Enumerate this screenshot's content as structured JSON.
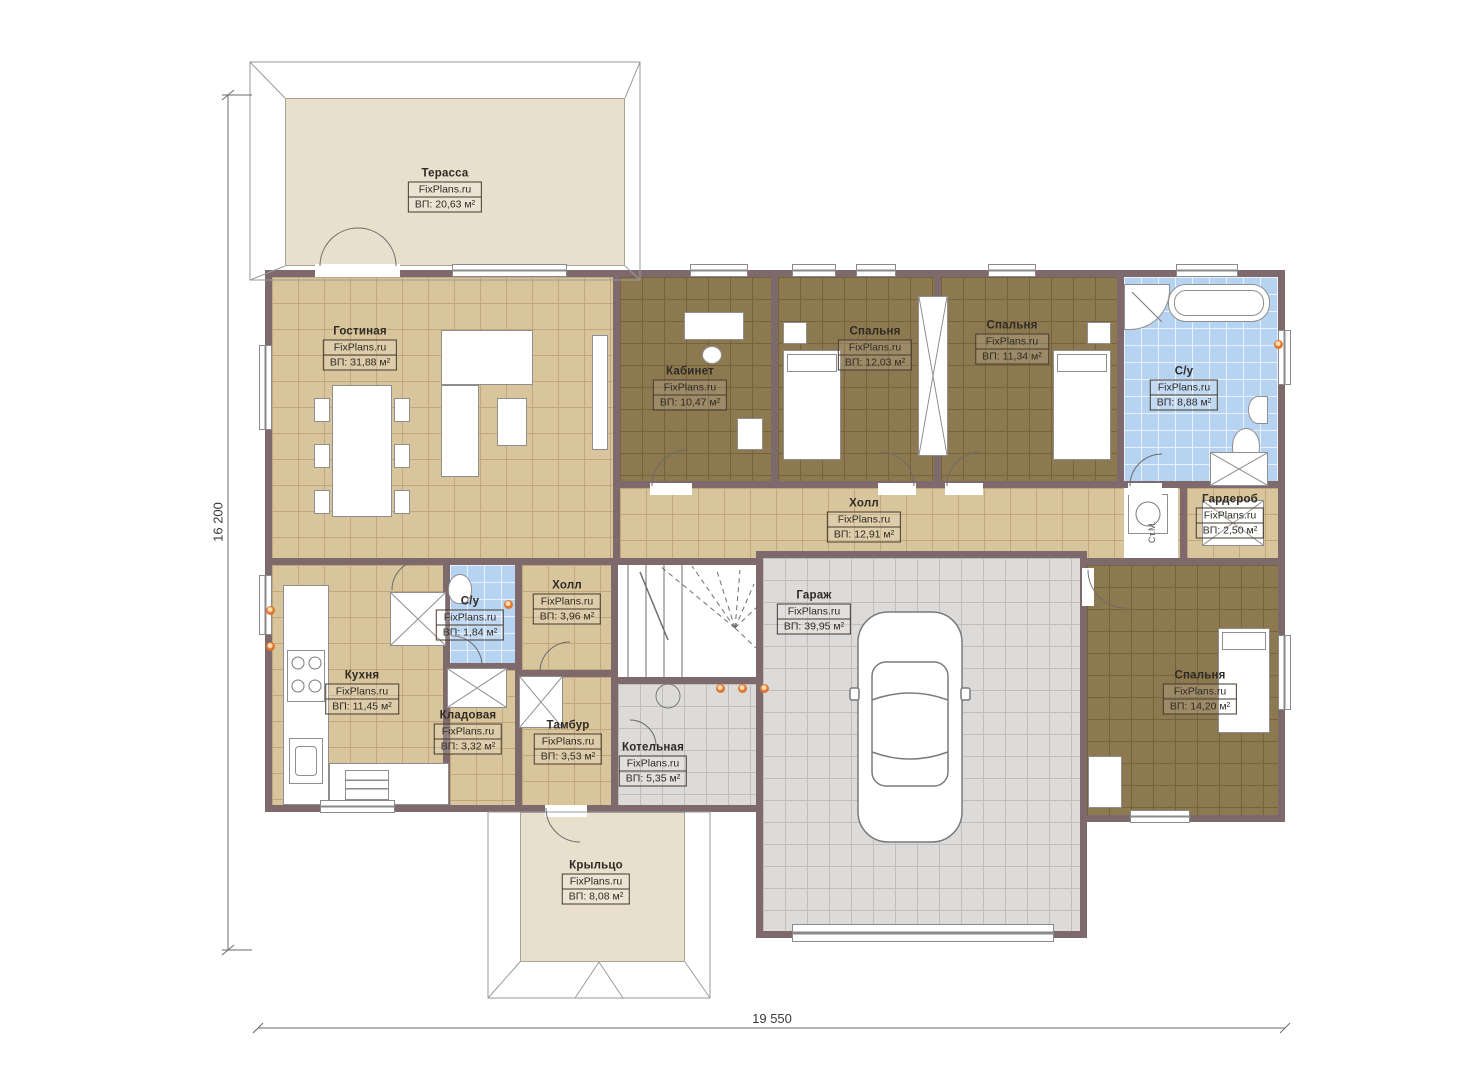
{
  "plan": {
    "site": "FixPlans.ru",
    "dimensions": {
      "height_label": "16 200",
      "width_label": "19 550"
    },
    "washer_label": "Ст.М.",
    "rooms": [
      {
        "id": "terrace",
        "name": "Терасса",
        "area": "ВП: 20,63 м²"
      },
      {
        "id": "living",
        "name": "Гостиная",
        "area": "ВП: 31,88 м²"
      },
      {
        "id": "office",
        "name": "Кабинет",
        "area": "ВП: 10,47 м²"
      },
      {
        "id": "bedroom-1",
        "name": "Спальня",
        "area": "ВП: 12,03 м²"
      },
      {
        "id": "bedroom-2",
        "name": "Спальня",
        "area": "ВП: 11,34 м²"
      },
      {
        "id": "bathroom",
        "name": "С/у",
        "area": "ВП: 8,88 м²"
      },
      {
        "id": "wardrobe",
        "name": "Гардероб",
        "area": "ВП: 2,50 м²"
      },
      {
        "id": "hall",
        "name": "Холл",
        "area": "ВП: 12,91 м²"
      },
      {
        "id": "garage",
        "name": "Гараж",
        "area": "ВП: 39,95 м²"
      },
      {
        "id": "bedroom-3",
        "name": "Спальня",
        "area": "ВП: 14,20 м²"
      },
      {
        "id": "kitchen",
        "name": "Кухня",
        "area": "ВП: 11,45 м²"
      },
      {
        "id": "wc",
        "name": "С/у",
        "area": "ВП: 1,84 м²"
      },
      {
        "id": "hall-2",
        "name": "Холл",
        "area": "ВП: 3,96 м²"
      },
      {
        "id": "pantry",
        "name": "Кладовая",
        "area": "ВП: 3,32 м²"
      },
      {
        "id": "vestibule",
        "name": "Тамбур",
        "area": "ВП: 3,53 м²"
      },
      {
        "id": "boiler",
        "name": "Котельная",
        "area": "ВП: 5,35 м²"
      },
      {
        "id": "porch",
        "name": "Крыльцо",
        "area": "ВП: 8,08 м²"
      }
    ],
    "colors": {
      "wall": "#7e6a6c",
      "tan": "#d8c59c",
      "brown": "#8d7950",
      "blue": "#b7d3f2",
      "gray": "#dcdbd9",
      "beige": "#e8dfcc",
      "accent": "#e0762e"
    }
  }
}
